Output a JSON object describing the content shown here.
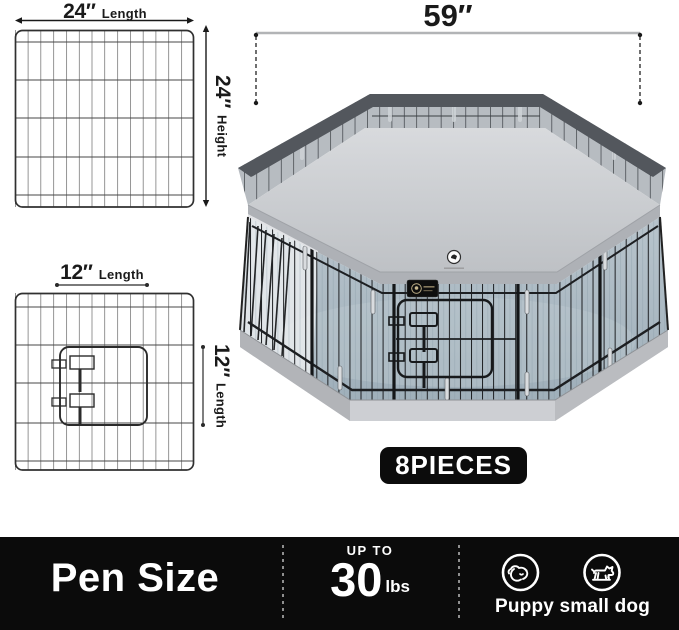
{
  "colors": {
    "bar_bg": "#0b0b0b",
    "badge_bg": "#0c0c0c",
    "text_dark": "#1a1a1a",
    "text_light": "#ffffff",
    "cover_gray": "#c9cbd0",
    "interior_blue_gray": "#aebcc6",
    "mesh_dark": "#53575d",
    "wire_black": "#1d1f22",
    "dim_line_gray": "#b2b4b6"
  },
  "diagrams": {
    "panel": {
      "length": {
        "value": "24″",
        "label": "Length"
      },
      "height": {
        "value": "24″",
        "label": "Height"
      }
    },
    "door": {
      "top": {
        "value": "12″",
        "label": "Length"
      },
      "side": {
        "value": "12″",
        "label": "Length"
      }
    },
    "pen": {
      "width_value": "59″"
    }
  },
  "badges": {
    "pieces": "8PIECES"
  },
  "bottom_bar": {
    "title": "Pen Size",
    "weight": {
      "prefix": "UP TO",
      "value": "30",
      "unit": "lbs"
    },
    "dogs": {
      "label": "Puppy small dog",
      "icons": [
        "sleeping-puppy-icon",
        "standing-small-dog-icon"
      ]
    }
  }
}
